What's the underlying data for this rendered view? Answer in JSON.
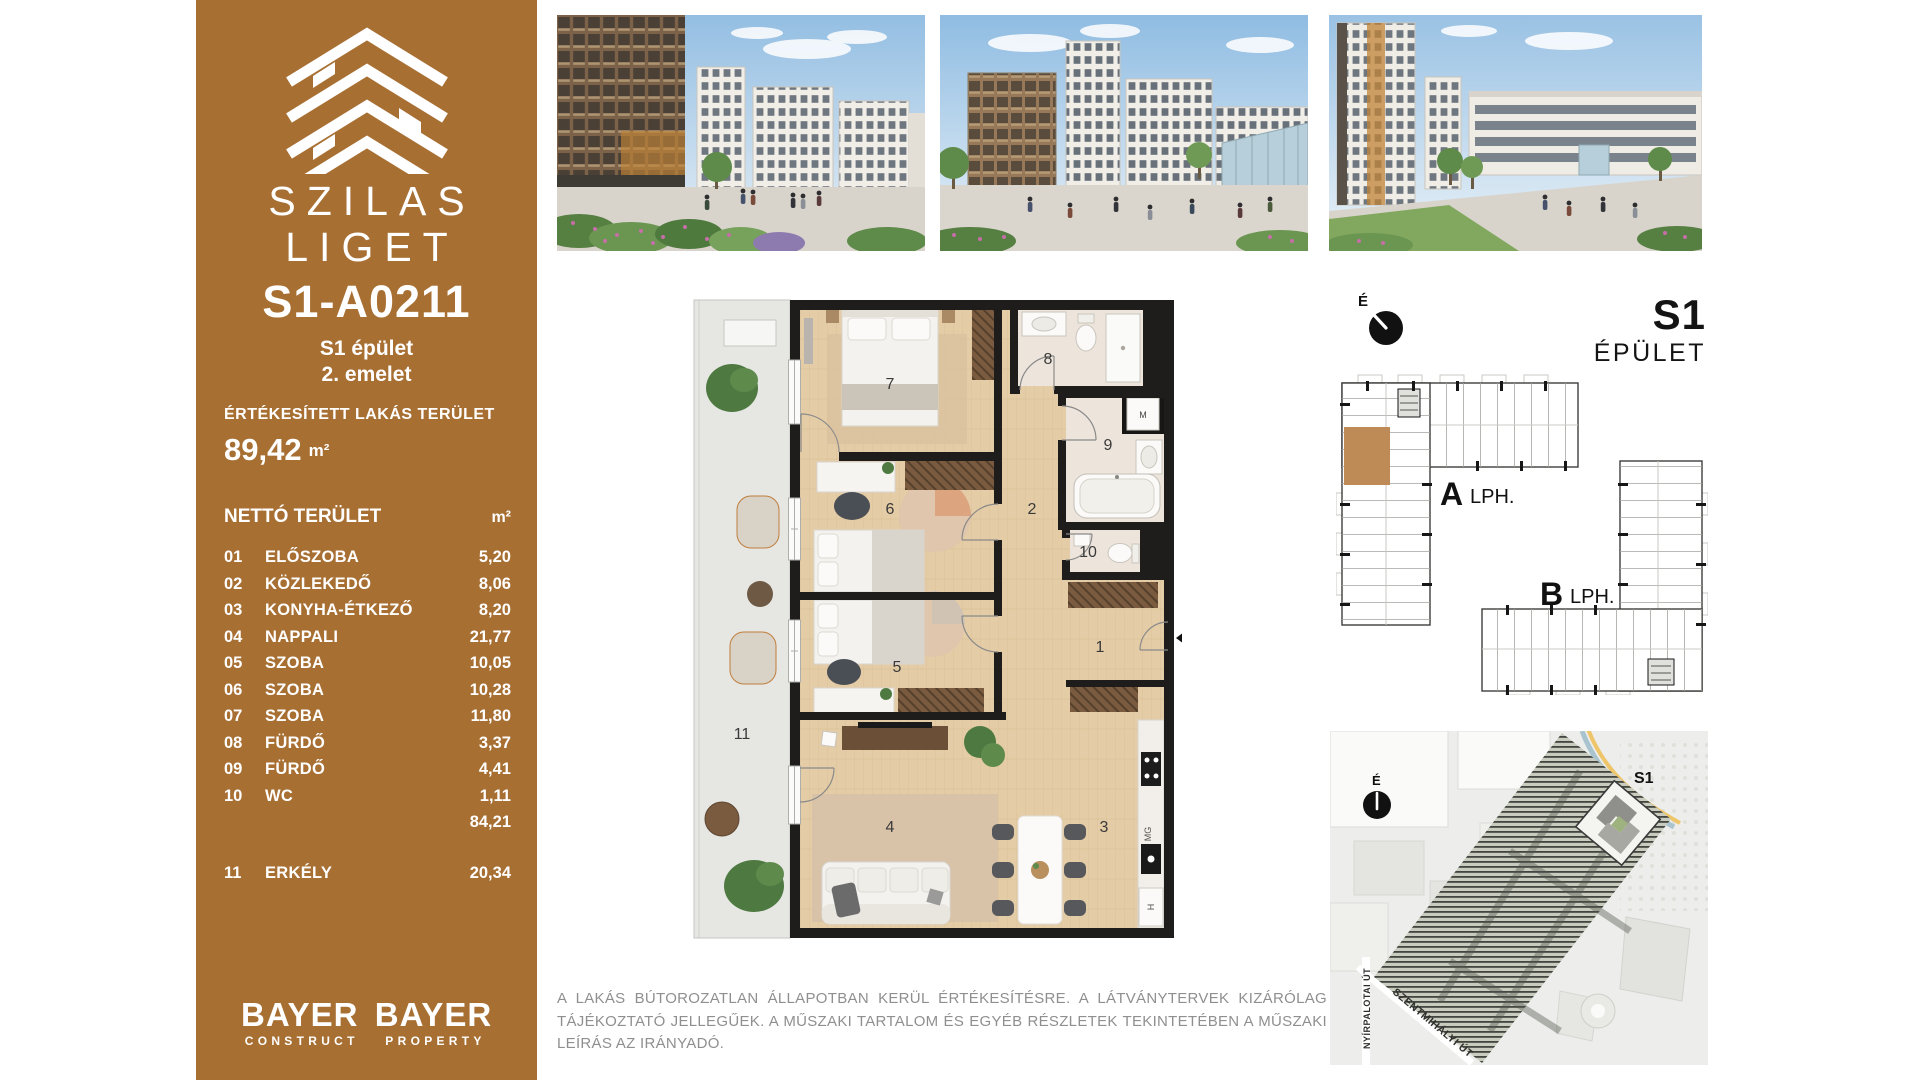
{
  "brand": {
    "name_line1": "SZILAS",
    "name_line2": "LIGET",
    "footer_logos": [
      {
        "name": "BAYER",
        "sub": "CONSTRUCT"
      },
      {
        "name": "BAYER",
        "sub": "PROPERTY"
      }
    ]
  },
  "unit": {
    "id": "S1-A0211",
    "building": "S1 épület",
    "floor": "2. emelet",
    "sold_area_label": "ÉRTÉKESÍTETT LAKÁS TERÜLET",
    "sold_area_value": "89,42",
    "sold_area_unit": "m²",
    "net_area_label": "NETTÓ TERÜLET",
    "net_area_unit_header": "m²",
    "rooms": [
      {
        "no": "01",
        "name": "ELŐSZOBA",
        "area": "5,20"
      },
      {
        "no": "02",
        "name": "KÖZLEKEDŐ",
        "area": "8,06"
      },
      {
        "no": "03",
        "name": "KONYHA-ÉTKEZŐ",
        "area": "8,20"
      },
      {
        "no": "04",
        "name": "NAPPALI",
        "area": "21,77"
      },
      {
        "no": "05",
        "name": "SZOBA",
        "area": "10,05"
      },
      {
        "no": "06",
        "name": "SZOBA",
        "area": "10,28"
      },
      {
        "no": "07",
        "name": "SZOBA",
        "area": "11,80"
      },
      {
        "no": "08",
        "name": "FÜRDŐ",
        "area": "3,37"
      },
      {
        "no": "09",
        "name": "FÜRDŐ",
        "area": "4,41"
      },
      {
        "no": "10",
        "name": "WC",
        "area": "1,11"
      }
    ],
    "subtotal": "84,21",
    "balcony_row": {
      "no": "11",
      "name": "ERKÉLY",
      "area": "20,34"
    }
  },
  "floorplan": {
    "room_labels": [
      "1",
      "2",
      "3",
      "4",
      "5",
      "6",
      "7",
      "8",
      "9",
      "10",
      "11"
    ],
    "washer_label": "M",
    "kitchen_mg_label": "MG",
    "kitchen_h_label": "H"
  },
  "overview": {
    "compass_letter": "É",
    "building_code": "S1",
    "building_word": "ÉPÜLET",
    "stair_a_letter": "A",
    "stair_b_letter": "B",
    "stair_suffix": "LPH."
  },
  "sitemap": {
    "compass_letter": "É",
    "site_tag": "S1",
    "street_vertical": "NYÍRPALOTAI ÚT",
    "street_diagonal": "SZENTMIHÁLYI ÚT"
  },
  "disclaimer": {
    "line1": "A LAKÁS BÚTOROZATLAN ÁLLAPOTBAN KERÜL ÉRTÉKESÍTÉSRE. A LÁTVÁNYTERVEK KIZÁRÓLAG TÁJÉKOZTATÓ",
    "line2": "JELLEGŰEK. A MŰSZAKI TARTALOM ÉS EGYÉB RÉSZLETEK TEKINTETÉBEN A MŰSZAKI LEÍRÁS AZ IRÁNYADÓ."
  },
  "colors": {
    "sidebar_brown": "#A86F33",
    "unit_highlight": "#BE8A55",
    "plan_wall": "#1F1D1B",
    "plan_wood": "#E4CCA6"
  }
}
